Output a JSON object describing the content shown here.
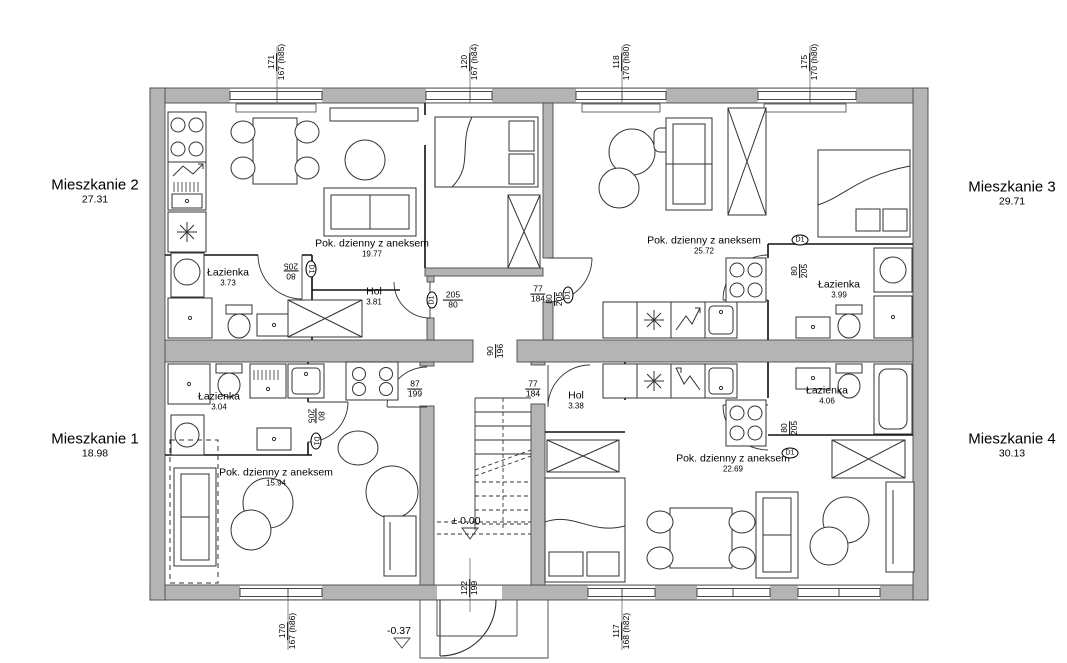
{
  "drawing_type": "floor-plan",
  "apartments": [
    {
      "name": "Mieszkanie 1",
      "area": "18.98"
    },
    {
      "name": "Mieszkanie 2",
      "area": "27.31"
    },
    {
      "name": "Mieszkanie 3",
      "area": "29.71"
    },
    {
      "name": "Mieszkanie 4",
      "area": "30.13"
    }
  ],
  "rooms": {
    "m2_living": {
      "label": "Pok. dzienny z aneksem",
      "area": "19.77"
    },
    "m2_bath": {
      "label": "Łazienka",
      "area": "3.73"
    },
    "m2_hol": {
      "label": "Hol",
      "area": "3.81"
    },
    "m3_living": {
      "label": "Pok. dzienny z aneksem",
      "area": "25.72"
    },
    "m3_bath": {
      "label": "Łazienka",
      "area": "3.99"
    },
    "m1_bath": {
      "label": "Łazienka",
      "area": "3.04"
    },
    "m1_living": {
      "label": "Pok. dzienny z aneksem",
      "area": "15.94"
    },
    "m4_hol": {
      "label": "Hol",
      "area": "3.38"
    },
    "m4_bath": {
      "label": "Łazienka",
      "area": "4.06"
    },
    "m4_living": {
      "label": "Pok. dzienny z aneksem",
      "area": "22.69"
    }
  },
  "window_dims": {
    "top": [
      {
        "w": "171",
        "h": "167 (h85)"
      },
      {
        "w": "120",
        "h": "167 (h84)"
      },
      {
        "w": "118",
        "h": "170 (h80)"
      },
      {
        "w": "175",
        "h": "170 (h80)"
      }
    ],
    "bottom": [
      {
        "w": "170",
        "h": "167 (h86)"
      },
      {
        "w": "117",
        "h": "168 (h82)"
      }
    ],
    "entrance": {
      "w": "122",
      "h": "199"
    }
  },
  "doors": {
    "m2_entry": {
      "tag": "D1",
      "num": "205",
      "den": "80"
    },
    "m3_entry": {
      "tag": "D1",
      "num": "77",
      "den": "184",
      "num2": "80",
      "den2": "205"
    },
    "m2_bath": {
      "tag": "D1",
      "num": "80",
      "den": "205"
    },
    "m1_bath": {
      "tag": "D1",
      "num": "80",
      "den": "205"
    },
    "m3_bath": {
      "tag": "D1",
      "num": "80",
      "den": "205"
    },
    "m4_bath": {
      "tag": "D1",
      "num": "80",
      "den": "205"
    },
    "m1_entry": {
      "num": "87",
      "den": "199"
    },
    "m4_entry": {
      "num": "77",
      "den": "184"
    },
    "corridor": {
      "num": "90",
      "den": "196"
    }
  },
  "levels": {
    "ground": "± 0.00",
    "outside": "-0.37"
  },
  "colors": {
    "wall": "#b4b4b4",
    "wall_stroke": "#4a4a4a",
    "line": "#222222"
  }
}
